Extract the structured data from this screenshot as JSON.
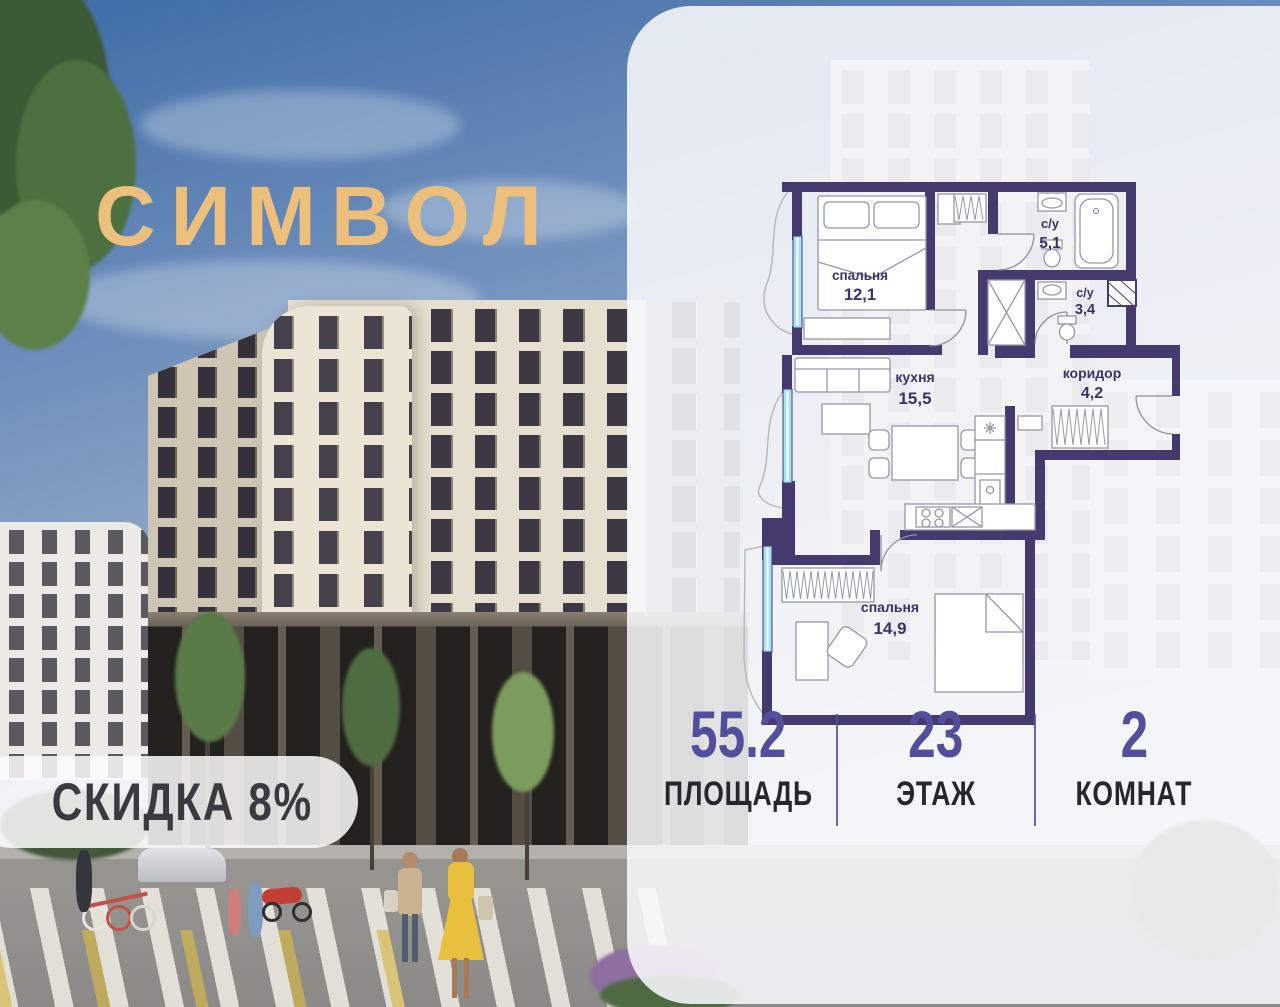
{
  "brand": {
    "logo_text": "СИМВОЛ"
  },
  "discount_badge": {
    "label": "СКИДКА 8%"
  },
  "floorplan": {
    "rooms": [
      {
        "name": "спальня",
        "area": "12,1"
      },
      {
        "name": "с/у",
        "area": "5,1"
      },
      {
        "name": "с/у",
        "area": "3,4"
      },
      {
        "name": "кухня",
        "area": "15,5"
      },
      {
        "name": "коридор",
        "area": "4,2"
      },
      {
        "name": "спальня",
        "area": "14,9"
      }
    ]
  },
  "stats": [
    {
      "value": "55.2",
      "label": "ПЛОЩАДЬ"
    },
    {
      "value": "23",
      "label": "ЭТАЖ"
    },
    {
      "value": "2",
      "label": "КОМНАТ"
    }
  ],
  "colors": {
    "accent": "#514f9b",
    "wall": "#443a6e",
    "glazing": "#a5e2ef",
    "logo_gold": "#ecc07c",
    "badge_text": "#3a3a40"
  }
}
